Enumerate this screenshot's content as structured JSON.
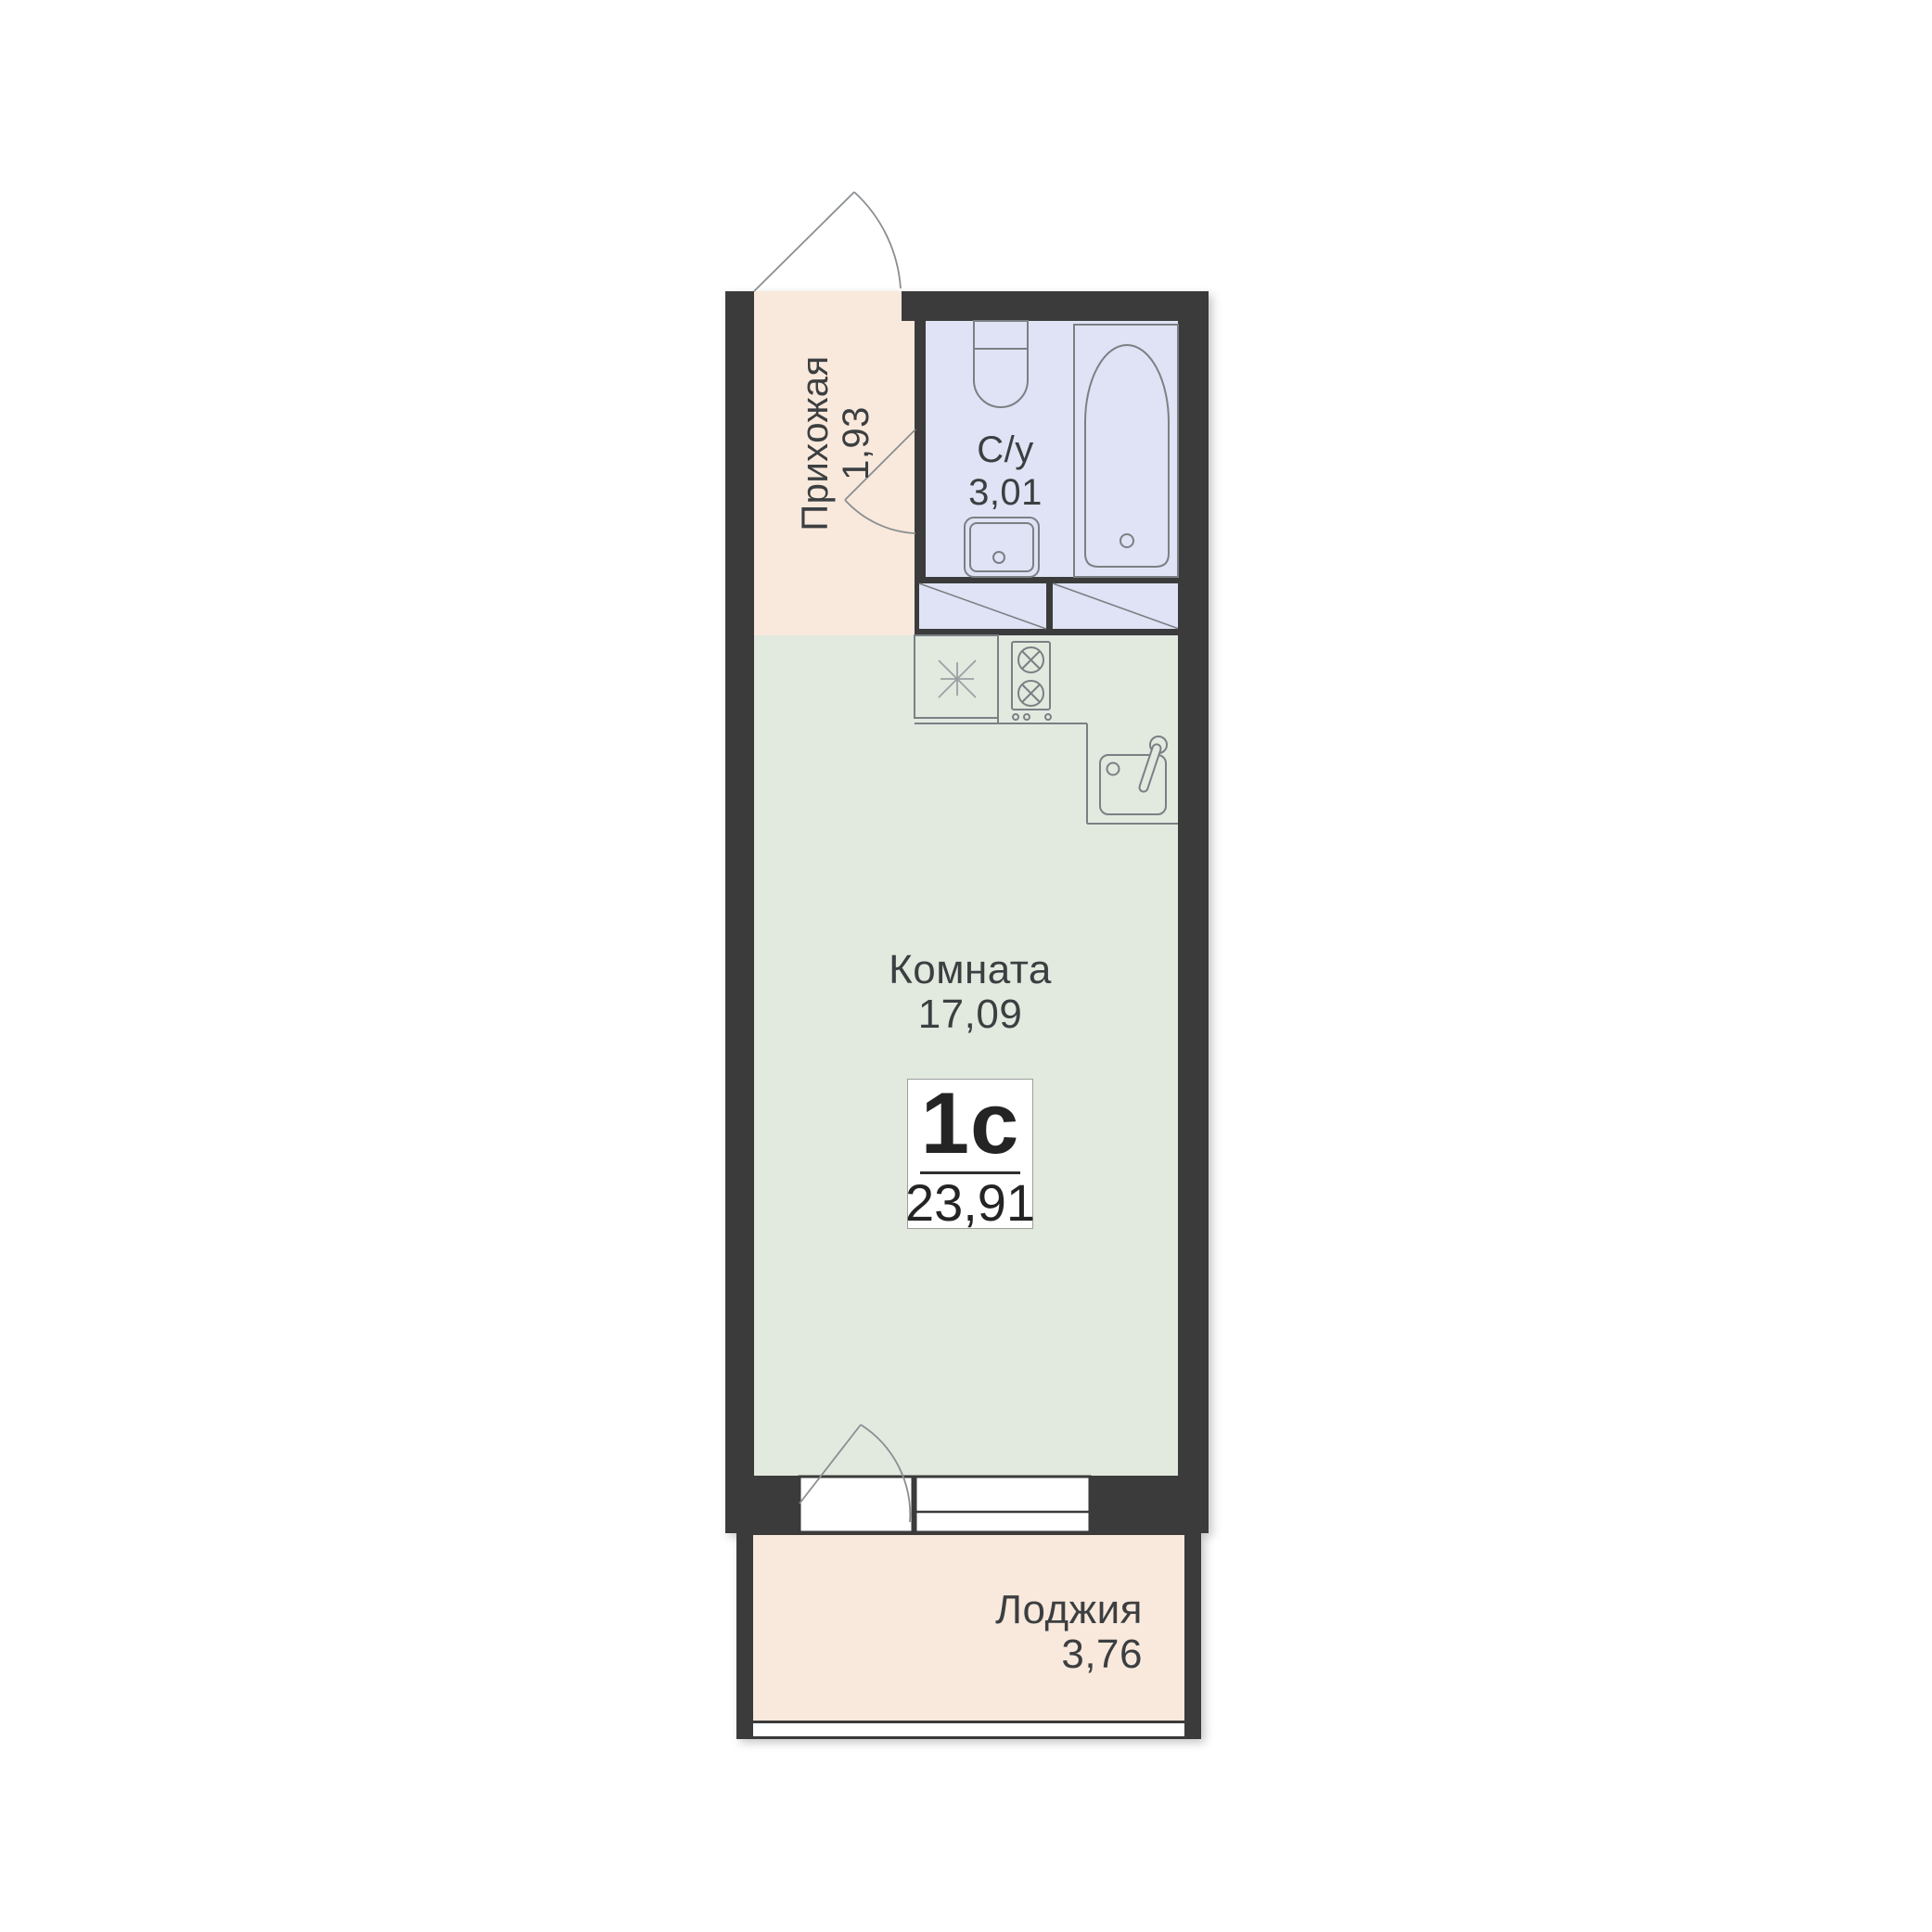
{
  "plan": {
    "badge": {
      "unit_type": "1с",
      "total_area": "23,91"
    },
    "hallway": {
      "name": "Прихожая",
      "area": "1,93"
    },
    "bathroom": {
      "name": "С/у",
      "area": "3,01"
    },
    "room": {
      "name": "Комната",
      "area": "17,09"
    },
    "loggia": {
      "name": "Лоджия",
      "area": "3,76"
    },
    "colors": {
      "wall": "#3b3b3b",
      "hallway_floor": "#f9e9dc",
      "bathroom_floor": "#dfe3f5",
      "room_floor": "#e2e9df",
      "loggia_floor": "#f9e9dc",
      "fixture_line": "#7b8084",
      "label_text": "#3c3f41",
      "background": "#ffffff"
    },
    "icons": [
      "entrance-door-swing-icon",
      "bathroom-door-swing-icon",
      "balcony-door-swing-icon",
      "toilet-icon",
      "bathtub-icon",
      "washbasin-icon",
      "kitchen-sink-icon",
      "hob-two-burner-icon",
      "star-symbol-icon",
      "ventilation-hatch-icon",
      "window-icon"
    ]
  }
}
